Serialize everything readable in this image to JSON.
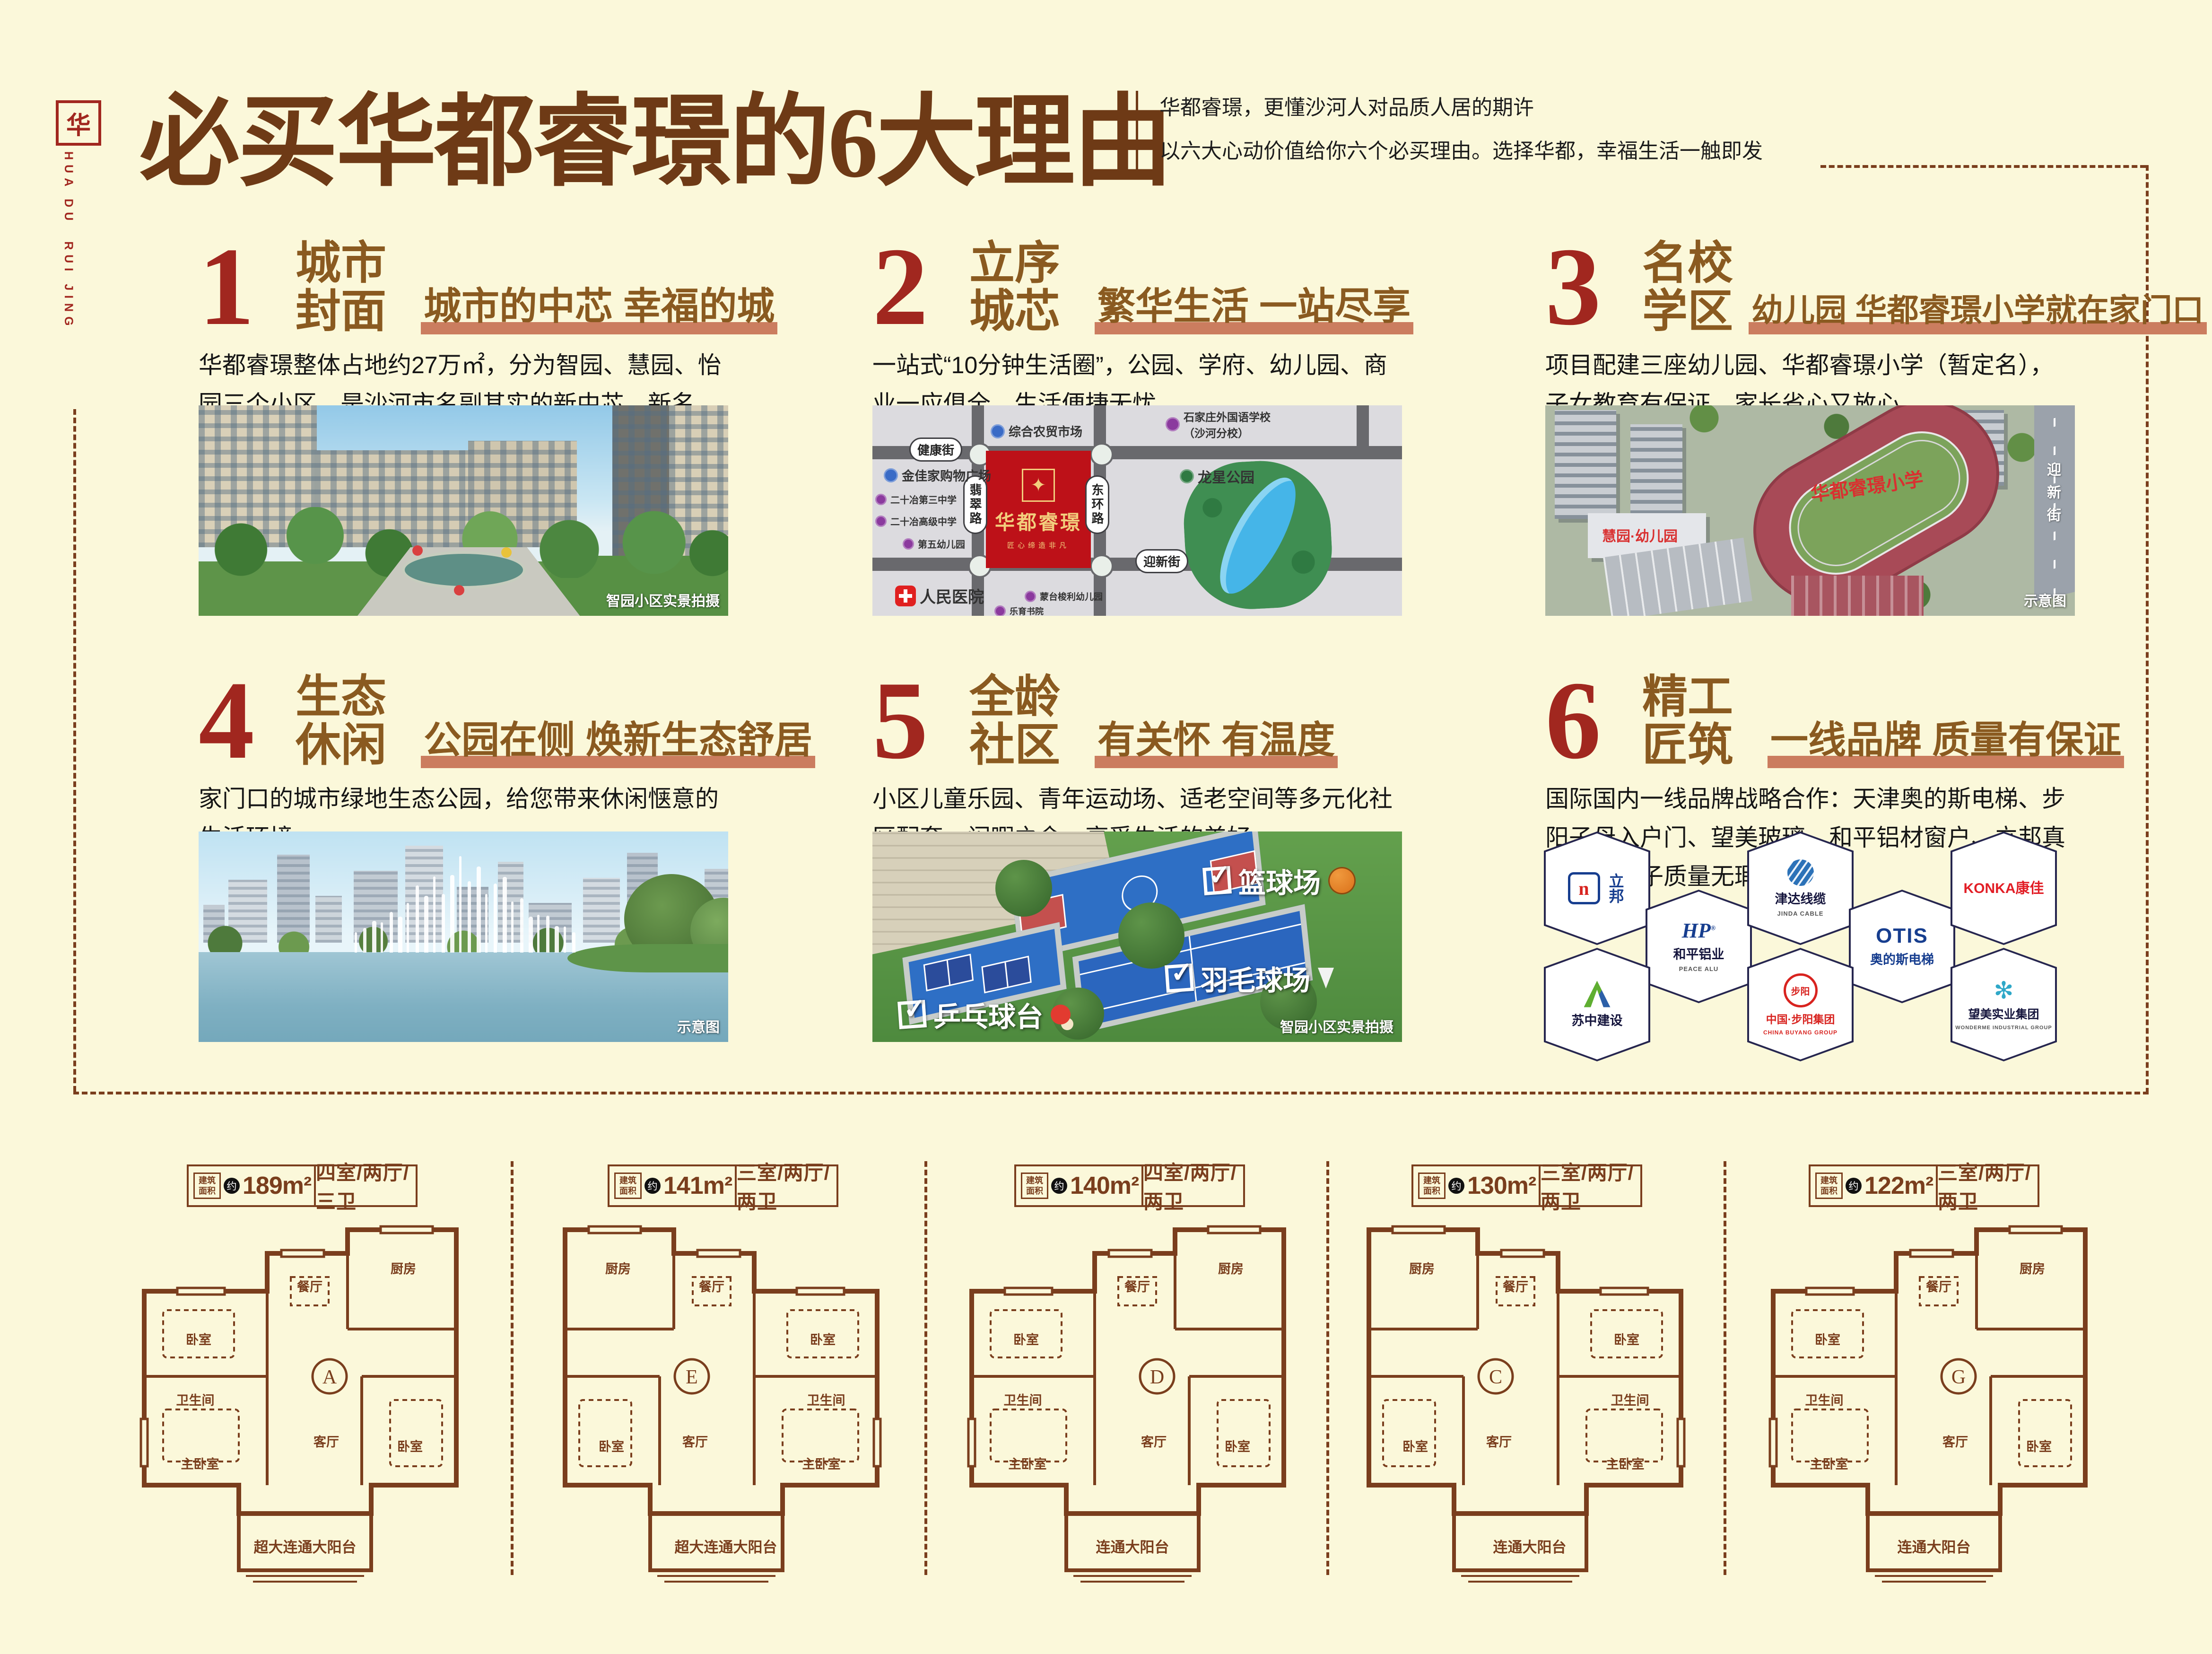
{
  "page": {
    "background": "#FBF8DA",
    "accent_red": "#A1271F",
    "accent_brown": "#8A5A20",
    "underline_salmon": "#CB7D5F",
    "plan_brown": "#7A3E1D"
  },
  "brand": {
    "seal_glyph": "华",
    "letters_line1": "HUA DU",
    "letters_line2": "RUI JING"
  },
  "header": {
    "title": "必买华都睿璟的6大理由",
    "tagline_line1": "华都睿璟，更懂沙河人对品质人居的期许",
    "tagline_line2": "以六大心动价值给你六个必买理由。选择华都，幸福生活一触即发"
  },
  "sections": [
    {
      "num": "1",
      "title1": "城市",
      "title2": "封面",
      "subtitle": "城市的中芯 幸福的城",
      "body": "华都睿璟整体占地约27万㎡，分为智园、慧园、怡园三个小区，是沙河市名副其实的新中芯、新名片、新封面。",
      "caption": "智园小区实景拍摄"
    },
    {
      "num": "2",
      "title1": "立序",
      "title2": "城芯",
      "subtitle": "繁华生活 一站尽享",
      "body": "一站式“10分钟生活圈”，公园、学府、幼儿园、商业一应俱全，生活便捷无忧。"
    },
    {
      "num": "3",
      "title1": "名校",
      "title2": "学区",
      "subtitle": "幼儿园 华都睿璟小学就在家门口",
      "body": "项目配建三座幼儿园、华都睿璟小学（暂定名），子女教育有保证，家长省心又放心。",
      "caption": "示意图",
      "school_label": "华都睿璟小学",
      "kindergarten_label": "慧园·幼儿园",
      "road_label": "迎新街"
    },
    {
      "num": "4",
      "title1": "生态",
      "title2": "休闲",
      "subtitle": "公园在侧 焕新生态舒居",
      "body": "家门口的城市绿地生态公园，给您带来休闲惬意的生活环境。",
      "caption": "示意图"
    },
    {
      "num": "5",
      "title1": "全龄",
      "title2": "社区",
      "subtitle": "有关怀 有温度",
      "body": "小区儿童乐园、青年运动场、适老空间等多元化社区配套，闲暇之余，享受生活的美好。",
      "caption": "智园小区实景拍摄",
      "court_labels": [
        "篮球场",
        "羽毛球场",
        "乒乓球台"
      ]
    },
    {
      "num": "6",
      "title1": "精工",
      "title2": "匠筑",
      "subtitle": "一线品牌 质量有保证",
      "body": "国际国内一线品牌战略合作：天津奥的斯电梯、步阳子母入户门、望美玻璃、和平铝材窗户、立邦真石漆，房子质量无瑕有保证。"
    }
  ],
  "map": {
    "project_name": "华都睿璟",
    "project_slogan": "匠心缔造非凡",
    "emblem_glyph": "✦",
    "road_top": "健康街",
    "road_left": "翡翠路",
    "road_right": "东环路",
    "road_bottom": "迎新街",
    "park_name": "龙星公园",
    "pois": [
      {
        "name": "综合农贸市场",
        "color": "#3A6BC6"
      },
      {
        "name": "石家庄外国语学校",
        "name2": "（沙河分校）",
        "color": "#8B3A9E"
      },
      {
        "name": "金佳家购物广场",
        "color": "#3A6BC6"
      },
      {
        "name": "二十冶第三中学",
        "color": "#8B3A9E"
      },
      {
        "name": "二十冶高级中学",
        "color": "#8B3A9E"
      },
      {
        "name": "第五幼儿园",
        "color": "#8B3A9E"
      },
      {
        "name": "人民医院",
        "color": "#E02020"
      },
      {
        "name": "蒙台梭利幼儿园",
        "color": "#8B3A9E"
      },
      {
        "name": "乐育书院",
        "color": "#8B3A9E"
      }
    ]
  },
  "brands": [
    {
      "zh": "立邦",
      "en": "",
      "mark": "n"
    },
    {
      "zh": "和平铝业",
      "en": "PEACE ALU",
      "mark": "HP"
    },
    {
      "zh": "津达线缆",
      "en": "JINDA CABLE",
      "mark": "sphere"
    },
    {
      "zh": "奥的斯电梯",
      "en": "OTIS",
      "mark": "OTIS"
    },
    {
      "zh": "KONKA康佳",
      "en": "",
      "mark": "KONKA"
    },
    {
      "zh": "苏中建设",
      "en": "",
      "mark": "chevron"
    },
    {
      "zh": "中国·步阳集团",
      "en": "CHINA BUYANG GROUP",
      "mark": "步阳"
    },
    {
      "zh": "望美实业集团",
      "en": "WONDERME INDUSTRIAL GROUP",
      "mark": "snowflake"
    }
  ],
  "floor_plans": [
    {
      "stamp": "建筑面积",
      "approx": "约",
      "area": "189m²",
      "layout": "四室/两厅/三卫",
      "letter": "A",
      "balcony": "超大连通大阳台",
      "rooms": [
        "卧室",
        "餐厅",
        "厨房",
        "卫生间",
        "主卧室",
        "客厅",
        "卧室"
      ]
    },
    {
      "stamp": "建筑面积",
      "approx": "约",
      "area": "141m²",
      "layout": "三室/两厅/两卫",
      "letter": "E",
      "balcony": "超大连通大阳台",
      "rooms": [
        "卧室",
        "餐厅",
        "厨房",
        "卫生间",
        "主卧室",
        "客厅",
        "卧室"
      ]
    },
    {
      "stamp": "建筑面积",
      "approx": "约",
      "area": "140m²",
      "layout": "四室/两厅/两卫",
      "letter": "D",
      "balcony": "连通大阳台",
      "rooms": [
        "卧室",
        "餐厅",
        "厨房",
        "卫生间",
        "主卧室",
        "客厅",
        "卧室"
      ]
    },
    {
      "stamp": "建筑面积",
      "approx": "约",
      "area": "130m²",
      "layout": "三室/两厅/两卫",
      "letter": "C",
      "balcony": "连通大阳台",
      "rooms": [
        "卧室",
        "餐厅",
        "厨房",
        "卫生间",
        "主卧室",
        "客厅",
        "卧室"
      ]
    },
    {
      "stamp": "建筑面积",
      "approx": "约",
      "area": "122m²",
      "layout": "三室/两厅/两卫",
      "letter": "G",
      "balcony": "连通大阳台",
      "rooms": [
        "卧室",
        "餐厅",
        "厨房",
        "卫生间",
        "主卧室",
        "客厅",
        "卧室"
      ]
    }
  ]
}
